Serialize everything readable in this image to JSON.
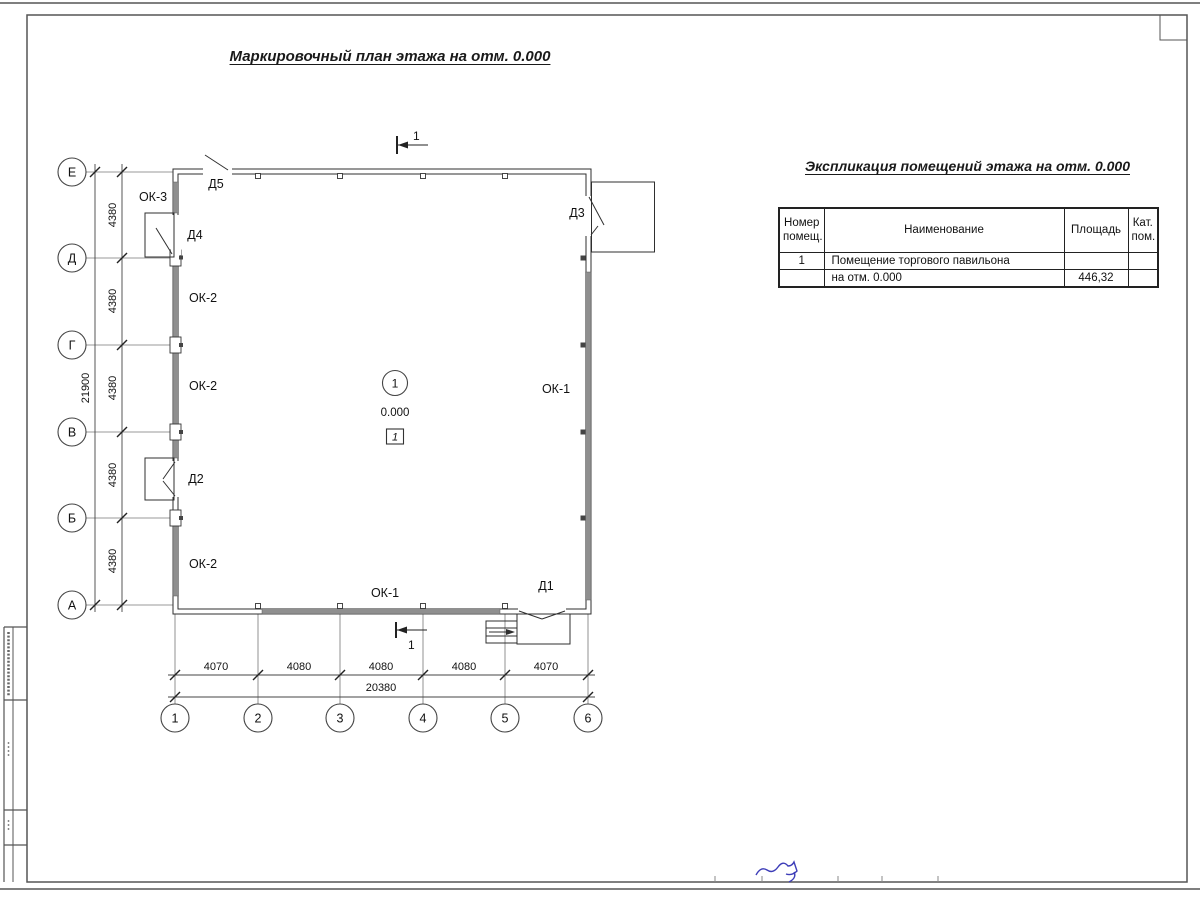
{
  "sheet": {
    "plan_title": "Маркировочный план этажа на отм. 0.000",
    "table_title": "Экспликация помещений этажа на отм. 0.000"
  },
  "plan": {
    "row_axes": [
      "Е",
      "Д",
      "Г",
      "В",
      "Б",
      "А"
    ],
    "col_axes": [
      "1",
      "2",
      "3",
      "4",
      "5",
      "6"
    ],
    "dims_left": [
      "4380",
      "4380",
      "4380",
      "4380",
      "4380"
    ],
    "dim_left_total": "21900",
    "dims_bottom": [
      "4070",
      "4080",
      "4080",
      "4080",
      "4070"
    ],
    "dim_bottom_total": "20380",
    "section_mark": "1",
    "room_number": "1",
    "elevation_mark": "0.000",
    "floor_type_mark": "1",
    "window_labels": {
      "ok3": "ОК-3",
      "ok2_top": "ОК-2",
      "ok2_mid": "ОК-2",
      "ok2_bottom": "ОК-2",
      "ok1_right": "ОК-1",
      "ok1_bottom": "ОК-1"
    },
    "door_labels": {
      "d1": "Д1",
      "d2": "Д2",
      "d3": "Д3",
      "d4": "Д4",
      "d5": "Д5"
    }
  },
  "table": {
    "headers": {
      "num_line1": "Номер",
      "num_line2": "помещ.",
      "name": "Наименование",
      "area": "Площадь",
      "cat_line1": "Кат.",
      "cat_line2": "пом."
    },
    "rows": [
      {
        "num": "1",
        "name": "Помещение торгового павильона",
        "area": "",
        "cat": ""
      },
      {
        "num": "",
        "name": "на отм. 0.000",
        "area": "446,32",
        "cat": ""
      }
    ]
  }
}
